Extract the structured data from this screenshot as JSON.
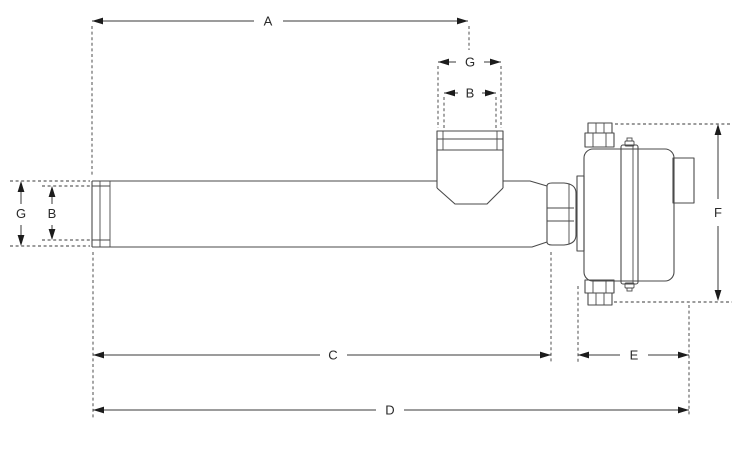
{
  "drawing": {
    "kind": "technical-dimension-drawing"
  },
  "colors": {
    "background": "#ffffff",
    "line": "#4a4a4a",
    "dimension": "#3a3a3a",
    "arrow": "#1c1c1c",
    "text": "#2a2a2a"
  },
  "dimensions": [
    {
      "label": "A",
      "orientation": "horizontal",
      "position": "top-overall-to-nozzle-center"
    },
    {
      "label": "G",
      "orientation": "horizontal",
      "position": "top-nozzle-outer-width"
    },
    {
      "label": "B",
      "orientation": "horizontal",
      "position": "top-nozzle-inner-width"
    },
    {
      "label": "G",
      "orientation": "vertical",
      "position": "left-tube-outer-diameter"
    },
    {
      "label": "B",
      "orientation": "vertical",
      "position": "left-tube-inner-diameter"
    },
    {
      "label": "C",
      "orientation": "horizontal",
      "position": "bottom-tube-length"
    },
    {
      "label": "E",
      "orientation": "horizontal",
      "position": "bottom-head-width"
    },
    {
      "label": "D",
      "orientation": "horizontal",
      "position": "bottom-overall-length"
    },
    {
      "label": "F",
      "orientation": "vertical",
      "position": "right-head-height"
    }
  ]
}
